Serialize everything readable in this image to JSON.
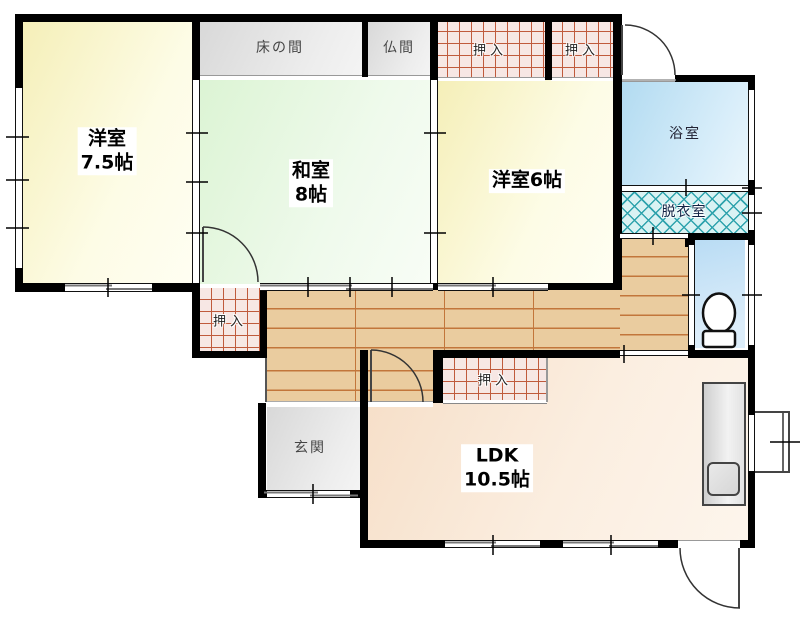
{
  "plan": {
    "title": "間取り図",
    "rooms": {
      "yoshitsu75": {
        "name": "洋室",
        "size": "7.5帖"
      },
      "washitsu": {
        "name": "和室",
        "size": "8帖"
      },
      "yoshitsu6": {
        "label": "洋室6帖"
      },
      "ldk": {
        "name": "LDK",
        "size": "10.5帖"
      },
      "tokonoma": {
        "label": "床の間"
      },
      "butsuma": {
        "label": "仏間"
      },
      "bathroom": {
        "label": "浴室"
      },
      "dressing_room": {
        "label": "脱衣室"
      },
      "genkan": {
        "label": "玄関"
      },
      "closet": {
        "label": "押入"
      }
    },
    "colors": {
      "wall": "#000000",
      "western_room_fill": "#f8f3c4",
      "tatami_room_fill": "#e2f5dc",
      "gray_room_fill": "#e0e0e0",
      "bathroom_fill": "#bfe0f2",
      "toilet_fill": "#c4e0f5",
      "ldk_fill": "#f8e3cf",
      "wood_floor_fill": "#eacc9f",
      "wood_floor_line": "#c2763b",
      "closet_fill": "#f7e7e4",
      "closet_grid_line": "#c05a3c",
      "dressing_fill": "#d9f2f3",
      "dressing_lattice_line": "#2fa3ad"
    }
  }
}
